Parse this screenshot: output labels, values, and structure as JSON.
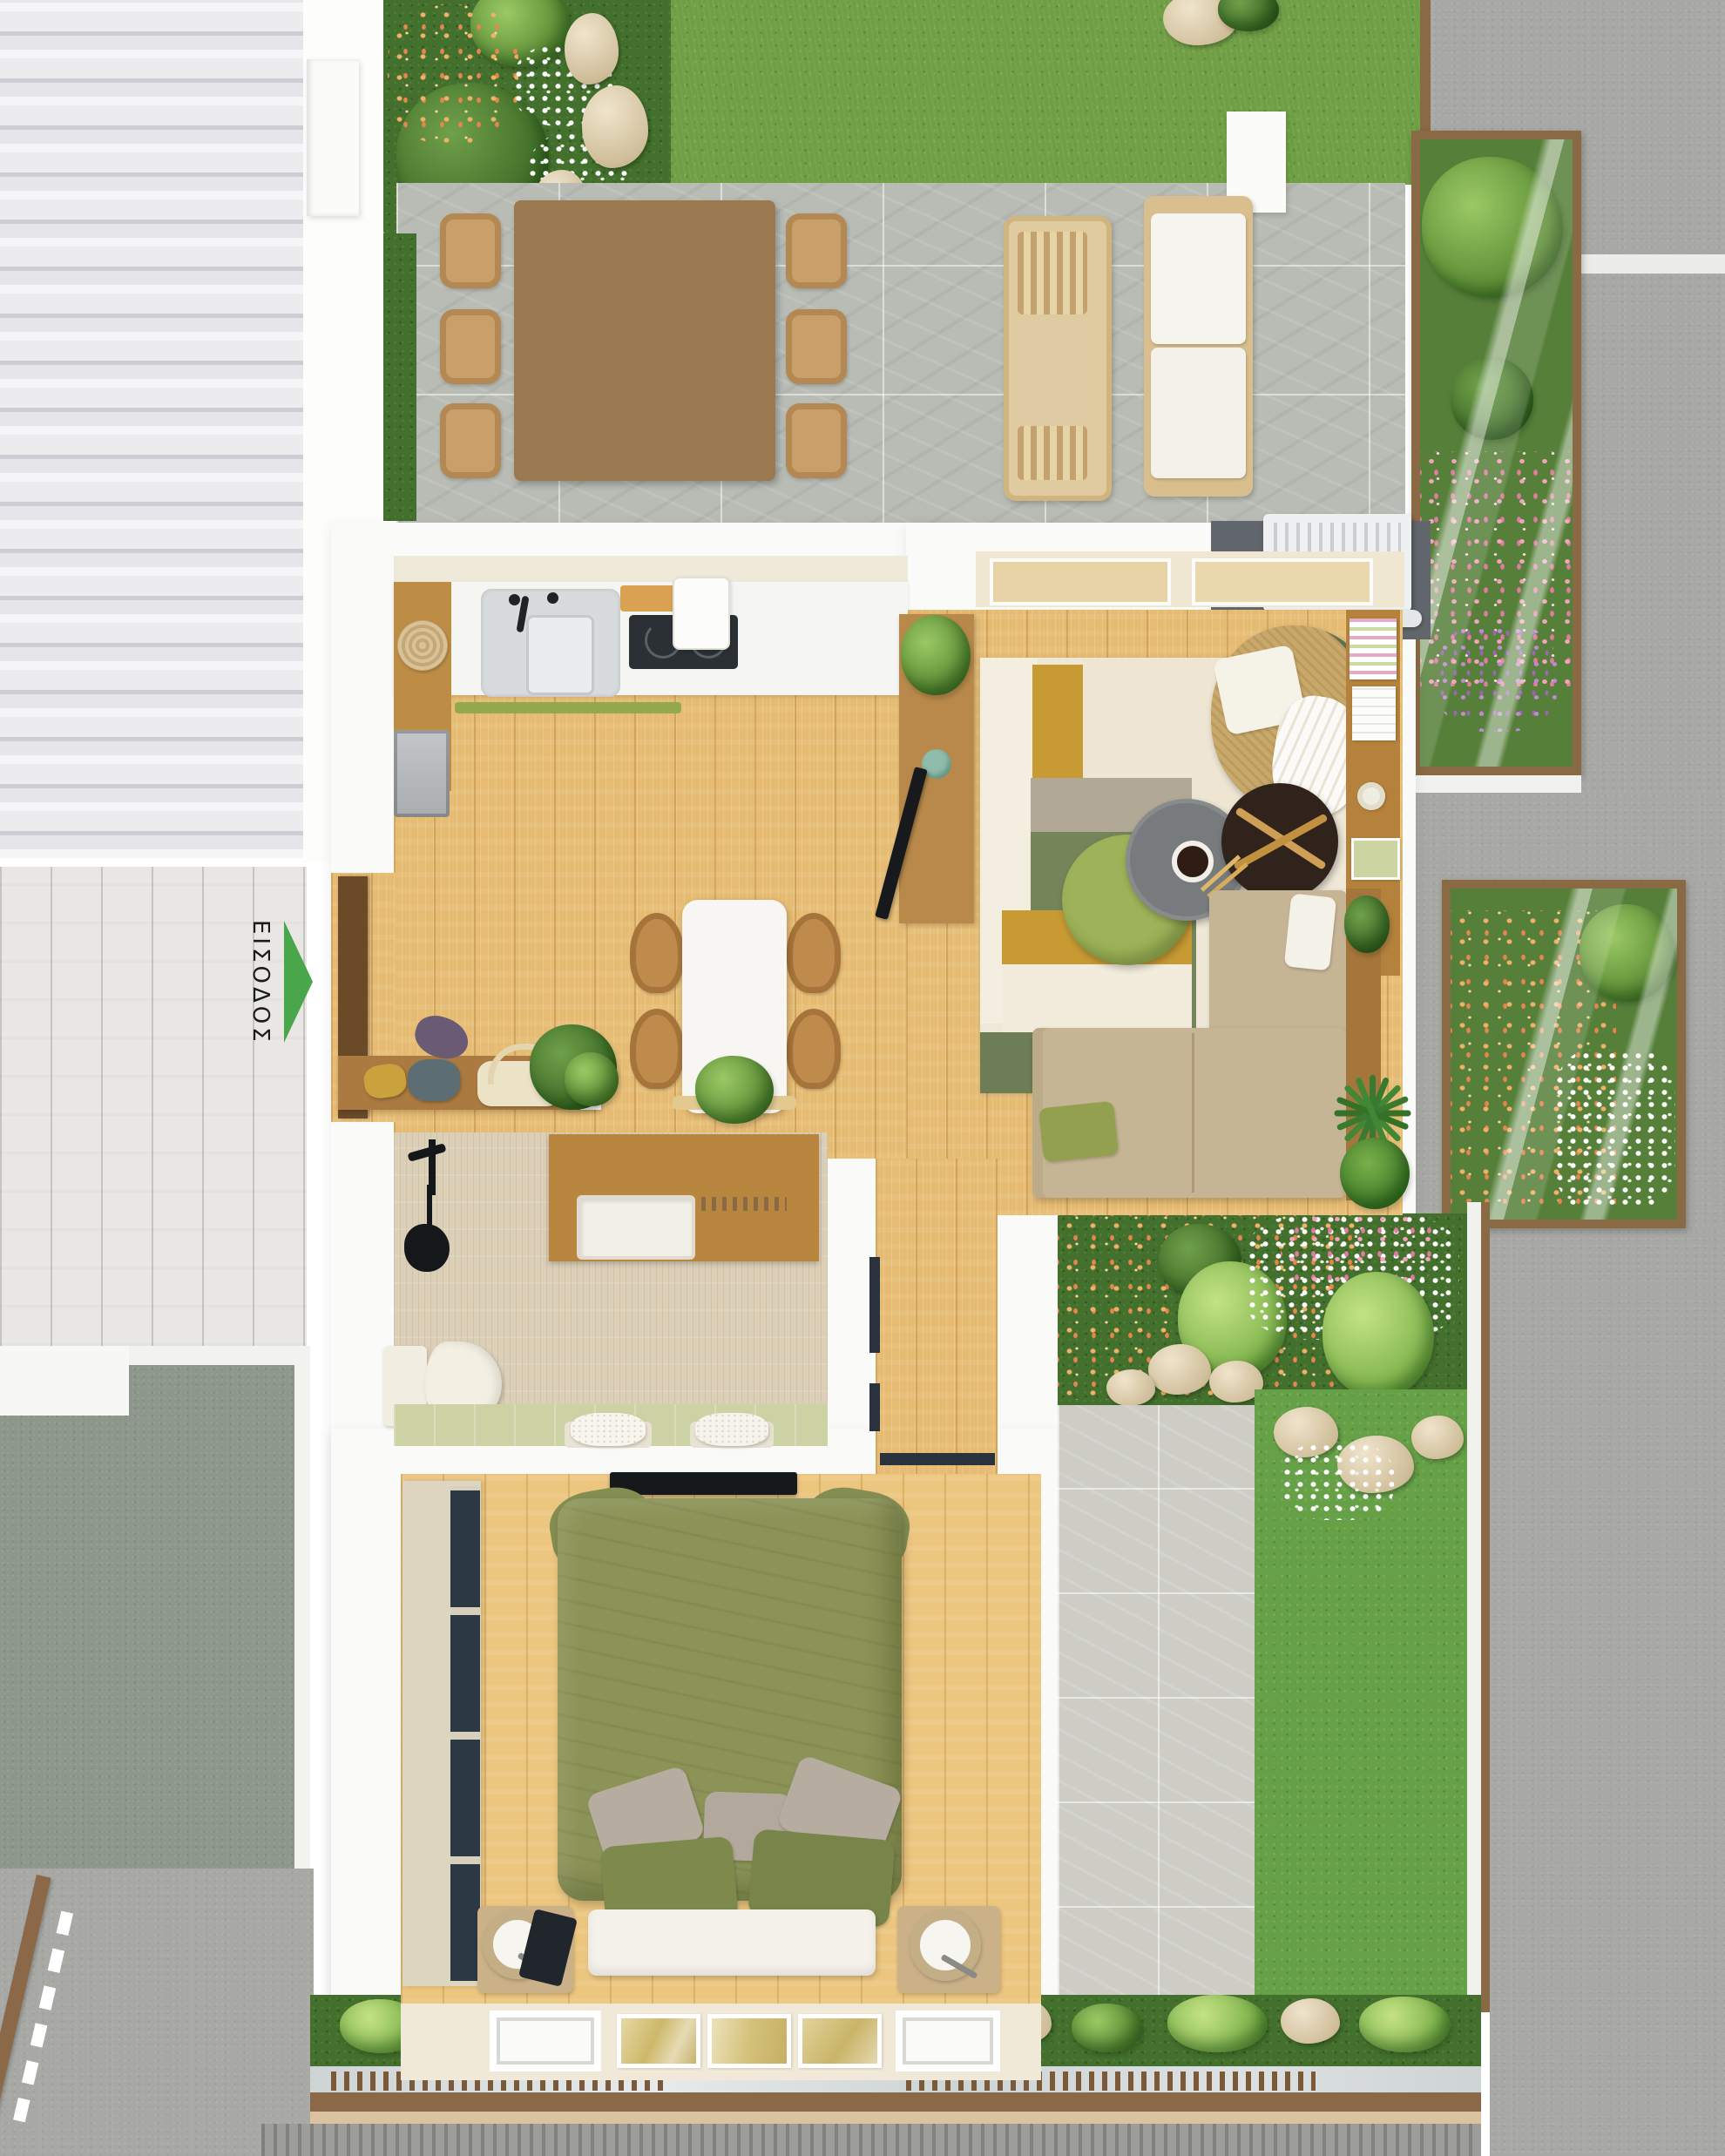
{
  "scene": {
    "entrance": {
      "label": "ΕΙΣΟΔΟΣ",
      "arrow_direction": "right",
      "arrow_color": "#4aa64a"
    }
  },
  "palette": {
    "wall_white": "#fafaf8",
    "wood_floor": "#e6bc74",
    "walkway_plank": "#e8e7e3",
    "roof_tile": "#ececef",
    "grass": "#6f9e44",
    "dark_bed_grass": "#43702c",
    "patio_stone": "#b9bcb5",
    "south_patio_stone": "#cdcdc6",
    "road_gray": "#a8a8a5",
    "side_lawn_sage": "#8e978c",
    "travertine_bath": "#dccfb8",
    "planter_frame_wood": "#8a6a44",
    "sofa_beige": "#c6b594",
    "duvet_olive": "#8b9357",
    "rug_green": "#75855a",
    "rug_gold": "#c79a33",
    "flower_pink": "#e17ba1",
    "flower_orange": "#e8854f",
    "flower_purple": "#9d66b5",
    "accent_green_pillow": "#92a050"
  }
}
